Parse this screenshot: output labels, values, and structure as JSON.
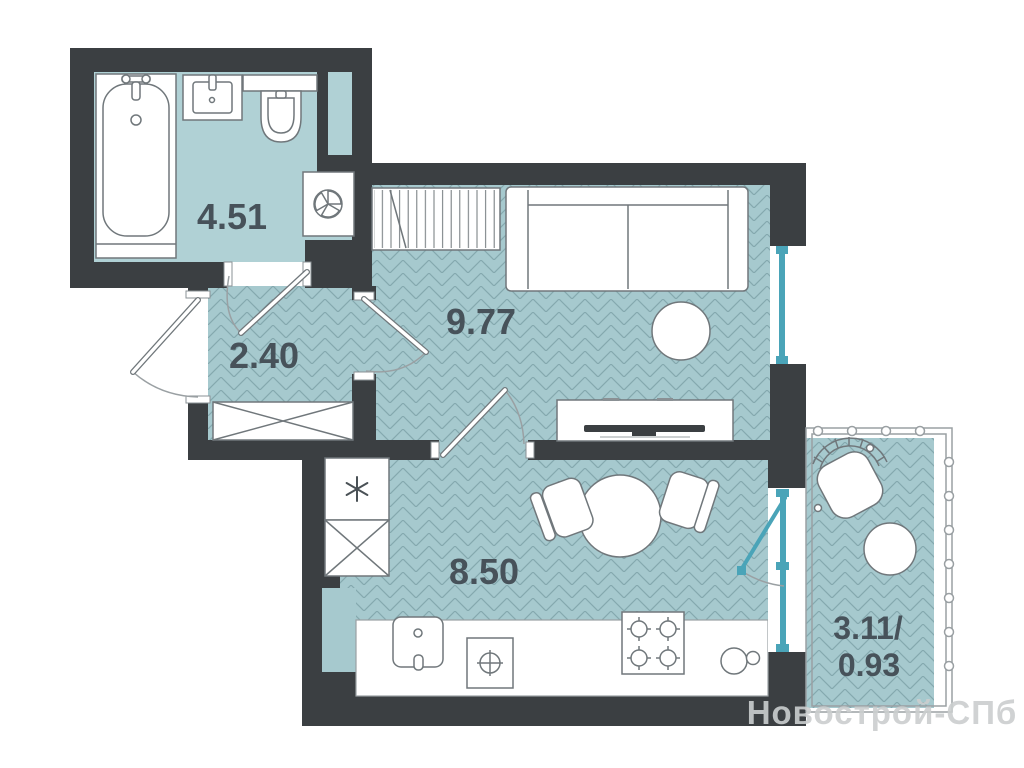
{
  "plan": {
    "watermark": "Новострой-СПб",
    "rooms": {
      "bathroom": {
        "name": "bathroom",
        "area": "4.51"
      },
      "hallway": {
        "name": "hallway",
        "area": "2.40"
      },
      "living": {
        "name": "living-room",
        "area": "9.77"
      },
      "kitchen": {
        "name": "kitchen",
        "area": "8.50"
      },
      "balcony": {
        "name": "balcony",
        "area_total": "3.11/",
        "area_reduced": "0.93"
      }
    },
    "colors": {
      "wall": "#3b3f42",
      "floor": "#a6c9ce",
      "bathroom_floor": "#b0d1d5",
      "window_frame": "#4aa4b8",
      "furniture_outline": "#70777b",
      "label_text": "#47525a",
      "watermark_text": "#cbcecf"
    },
    "fixtures": {
      "bathroom": [
        "bathtub",
        "washbasin",
        "toilet",
        "washing-machine"
      ],
      "hallway": [
        "wardrobe"
      ],
      "living": [
        "closet",
        "sofa",
        "side-table",
        "tv-stand"
      ],
      "kitchen": [
        "fridge",
        "tall-cabinet",
        "vent-shaft",
        "kitchen-sink",
        "hob",
        "stove",
        "round-sink",
        "dining-table",
        "dining-chair",
        "dining-chair"
      ],
      "balcony": [
        "wicker-armchair",
        "round-table"
      ]
    }
  }
}
